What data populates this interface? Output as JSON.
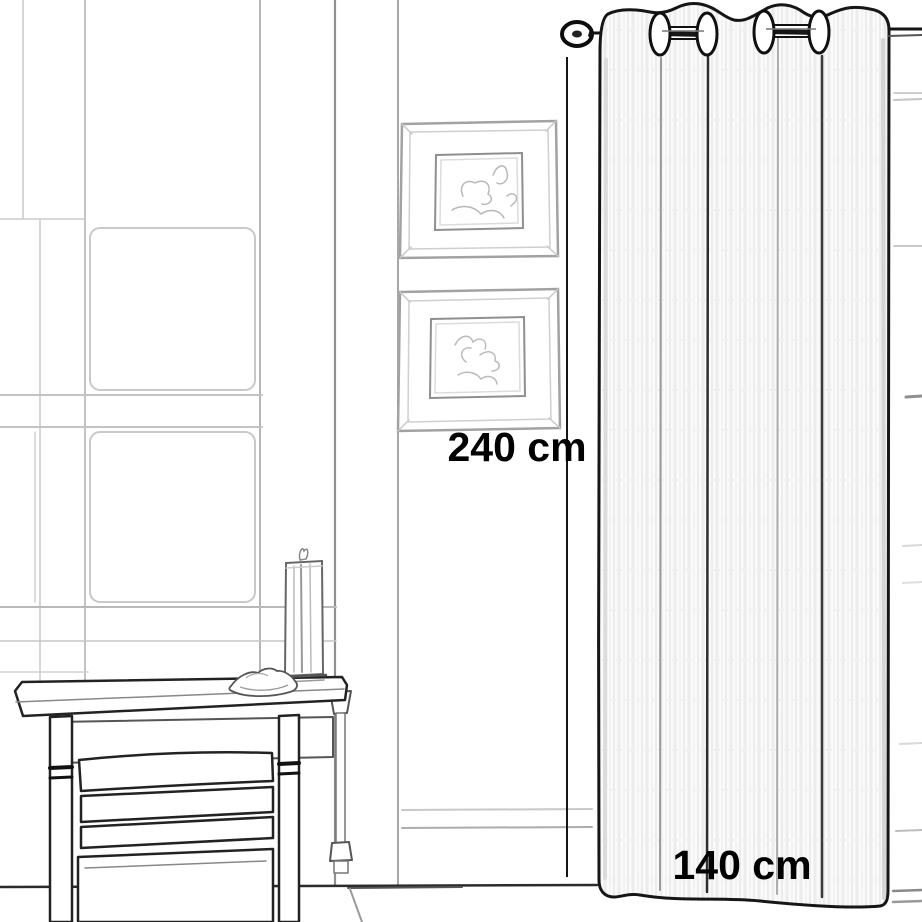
{
  "dimensions": {
    "height_label": "240 cm",
    "width_label": "140 cm"
  },
  "colors": {
    "background": "#ffffff",
    "label_color": "#000000",
    "ink": "#1a1a1a",
    "sketch_gray": "#c6c6c6",
    "curtain_shade": "#f5f5f5"
  }
}
